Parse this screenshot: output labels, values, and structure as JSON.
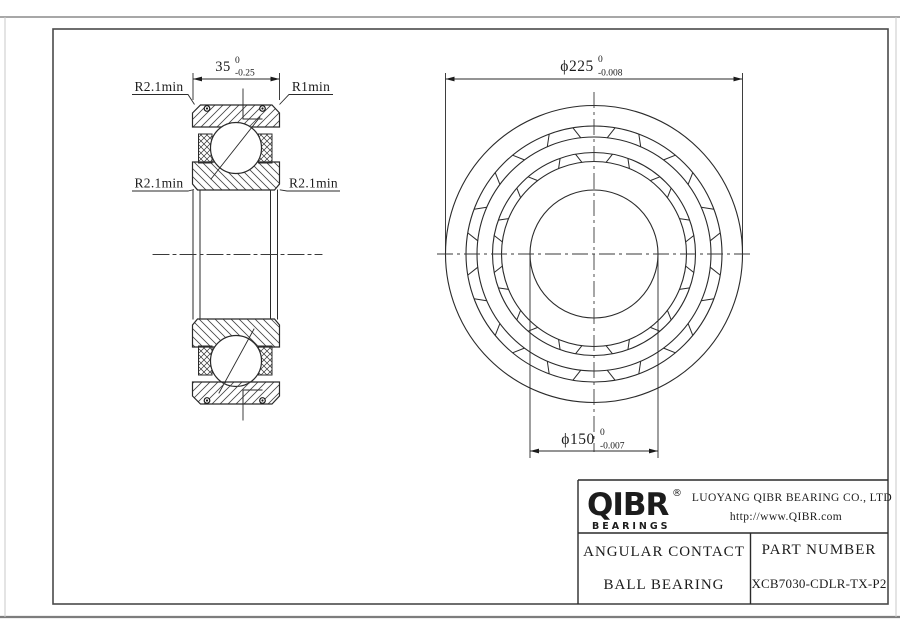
{
  "drawing": {
    "line_color": "#2a2a2a",
    "frame_color": "#4a4a4a",
    "background": "#ffffff"
  },
  "section_view": {
    "width_dimension": {
      "value": "35",
      "tol_upper": "0",
      "tol_lower": "-0.25"
    },
    "labels": {
      "top_left": "R2.1min",
      "top_right": "R1min",
      "mid_left": "R2.1min",
      "mid_right": "R2.1min"
    }
  },
  "front_view": {
    "outer_diameter": {
      "value": "ϕ225",
      "tol_upper": "0",
      "tol_lower": "-0.008"
    },
    "bore_diameter": {
      "value": "ϕ150",
      "tol_upper": "0",
      "tol_lower": "-0.007"
    }
  },
  "title_block": {
    "logo_text": "QIBR",
    "logo_reg": "®",
    "logo_sub": "BEARINGS",
    "company": "LUOYANG QIBR BEARING CO., LTD",
    "website": "http://www.QIBR.com",
    "product_line1": "ANGULAR CONTACT",
    "product_line2": "BALL BEARING",
    "part_number_label": "PART NUMBER",
    "part_number": "XCB7030-CDLR-TX-P2"
  }
}
